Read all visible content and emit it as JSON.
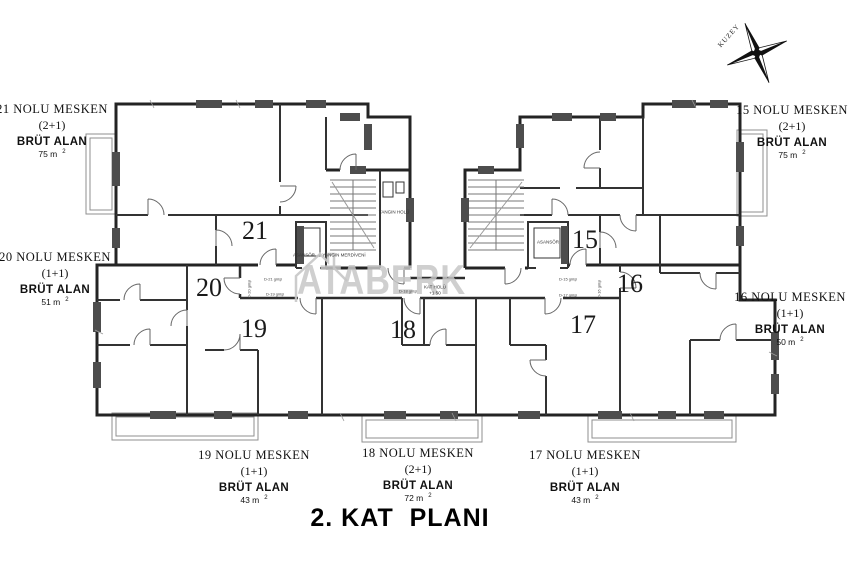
{
  "title": "2. KAT  PLANI",
  "compass": {
    "label": "KUZEY"
  },
  "watermark": {
    "text": "ATABERK"
  },
  "sup2": "2",
  "callouts": {
    "u21": {
      "name": "21 NOLU MESKEN",
      "plan": "(2+1)",
      "brut_label": "BRÜT ALAN",
      "area": "75 m"
    },
    "u20": {
      "name": "20 NOLU MESKEN",
      "plan": "(1+1)",
      "brut_label": "BRÜT ALAN",
      "area": "51 m"
    },
    "u19": {
      "name": "19 NOLU MESKEN",
      "plan": "(1+1)",
      "brut_label": "BRÜT ALAN",
      "area": "43 m"
    },
    "u18": {
      "name": "18 NOLU MESKEN",
      "plan": "(2+1)",
      "brut_label": "BRÜT ALAN",
      "area": "72 m"
    },
    "u17": {
      "name": "17 NOLU MESKEN",
      "plan": "(1+1)",
      "brut_label": "BRÜT ALAN",
      "area": "43 m"
    },
    "u16": {
      "name": "16 NOLU MESKEN",
      "plan": "(1+1)",
      "brut_label": "BRÜT ALAN",
      "area": "50 m"
    },
    "u15": {
      "name": "15 NOLU MESKEN",
      "plan": "(2+1)",
      "brut_label": "BRÜT ALAN",
      "area": "75 m"
    }
  },
  "plan_numbers": {
    "n21": "21",
    "n20": "20",
    "n19": "19",
    "n18": "18",
    "n17": "17",
    "n16": "16",
    "n15": "15"
  },
  "core": {
    "asansor": "ASANSÖR",
    "yangin_merdiveni": "YANGIN MERDİVENİ",
    "yangin_holu": "YANGIN HOLÜ",
    "kat_holu": "KAT HOLÜ",
    "kat_holu_level": "+1.50"
  },
  "entrances": {
    "d21": "D-21 girişi",
    "d20": "D-20 girişi",
    "d19": "D-19 girişi",
    "d18": "D-18 girişi",
    "d17": "D-17 girişi",
    "d16": "D-16 girişi",
    "d15": "D-15 girişi"
  }
}
